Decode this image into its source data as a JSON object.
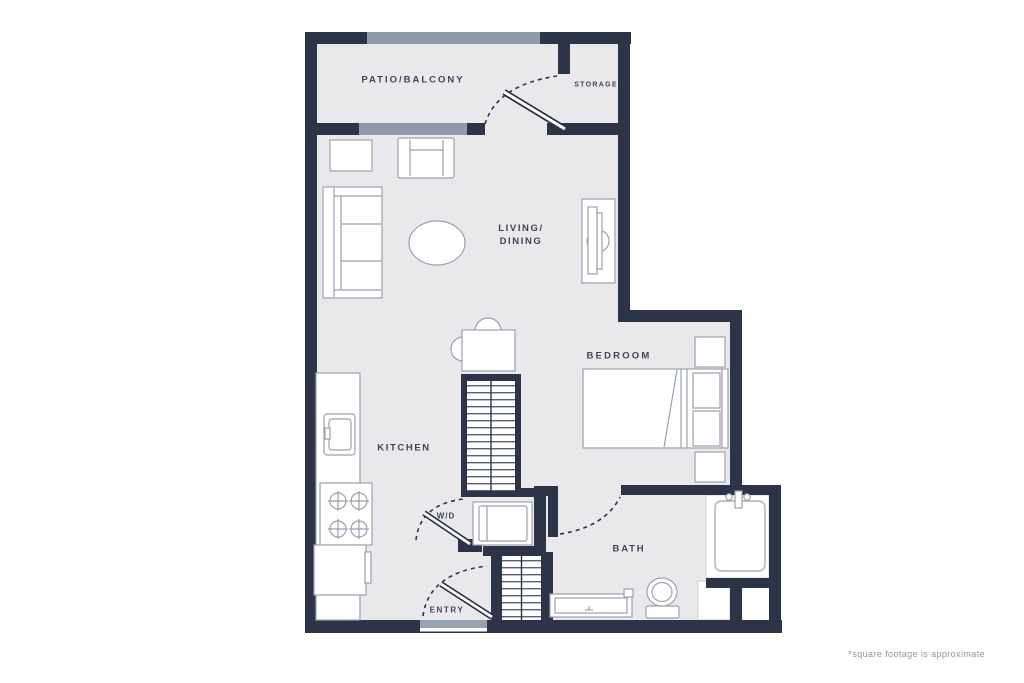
{
  "plan": {
    "type": "apartment-floor-plan",
    "rooms": {
      "patio": {
        "label": "PATIO/BALCONY"
      },
      "storage": {
        "label": "STORAGE"
      },
      "living_dining": {
        "line1": "LIVING/",
        "line2": "DINING"
      },
      "bedroom": {
        "label": "BEDROOM"
      },
      "kitchen": {
        "label": "KITCHEN"
      },
      "washer_dryer": {
        "label": "W/D"
      },
      "bath": {
        "label": "BATH"
      },
      "entry": {
        "label": "ENTRY"
      }
    },
    "footnote": "*square footage is approximate",
    "colors": {
      "background": "#ffffff",
      "wall": "#2e3447",
      "floor": "#e9e9ec",
      "glazing": "#8f9aab",
      "furniture_outline": "#9ba1ae",
      "tread_line": "#59617a",
      "label_text": "#3e4559",
      "footnote_text": "#8e93a2"
    },
    "icons": {
      "balcony_railing": "gray-band",
      "sliding_door": "gray-band",
      "entry_threshold": "gray-band",
      "door_swing": "dashed-arc",
      "door_leaf": "double-diagonal-line",
      "stairs": "striped-treads",
      "sofa": "rect-with-cushion-lines",
      "armchair": "rect-with-arm-lines",
      "side_table": "small-rect",
      "coffee_table": "ellipse",
      "tv_console": "rect-with-tv",
      "dining_table": "square-with-half-round-chairs",
      "kitchen_counter": "long-rect",
      "sink": "nested-rounded-rects",
      "stove": "four-cross-burners",
      "fridge": "rect-with-handle",
      "washer_dryer_unit": "nested-rects",
      "bed": "mattress-pillows-headboard",
      "nightstand": "small-square",
      "bathtub": "rounded-rect-with-faucet",
      "toilet": "oval-with-tank",
      "vanity": "rect-with-faucet"
    }
  }
}
